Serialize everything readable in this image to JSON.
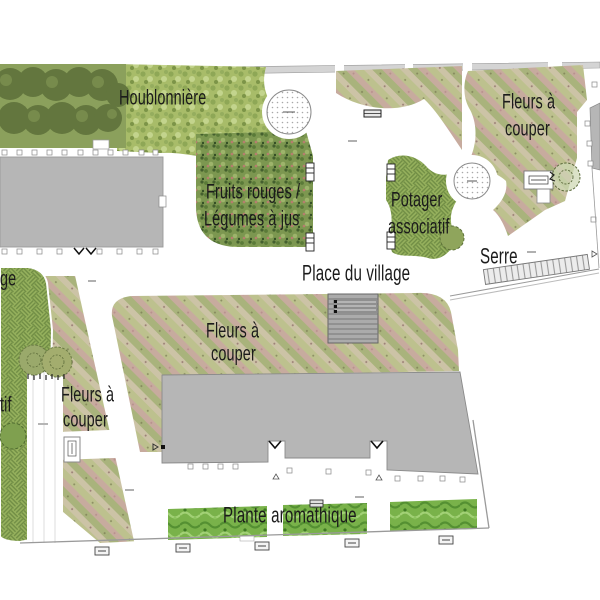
{
  "plan": {
    "title": "Plan masse — jardin de village",
    "labels": {
      "houblonniere": "Houblonnière",
      "fruits_line1": "Fruits rouges /",
      "fruits_line2": "Légumes à jus",
      "potager_line1": "Potager",
      "potager_line2": "associatif",
      "fleurs_top_right_line1": "Fleurs à",
      "fleurs_top_right_line2": "couper",
      "place_du_village": "Place du village",
      "serre": "Serre",
      "fleurs_center_line1": "Fleurs à",
      "fleurs_center_line2": "couper",
      "fleurs_left_line1": "Fleurs à",
      "fleurs_left_line2": "couper",
      "plante_aromathique": "Plante aromathique",
      "cut_label_top": "ge",
      "cut_label_bottom": "tif"
    },
    "colors": {
      "background": "#ffffff",
      "label_text": "#1b1b1b",
      "building_gray": "#b6b6b6",
      "building_stroke": "#8a8a8a",
      "tree_dark_green": "#5f7340",
      "meadow_green": "#a6bb68",
      "dense_planting_green": "#7c9750",
      "flower_hatch_sage": "#bdc18e",
      "flower_hatch_pink": "#c7ab9e",
      "basket_weave_green": "#96b15d",
      "aromatic_bright_green": "#79b24a",
      "stairs_gray": "#ababab",
      "boundary_gray": "#999999"
    }
  }
}
